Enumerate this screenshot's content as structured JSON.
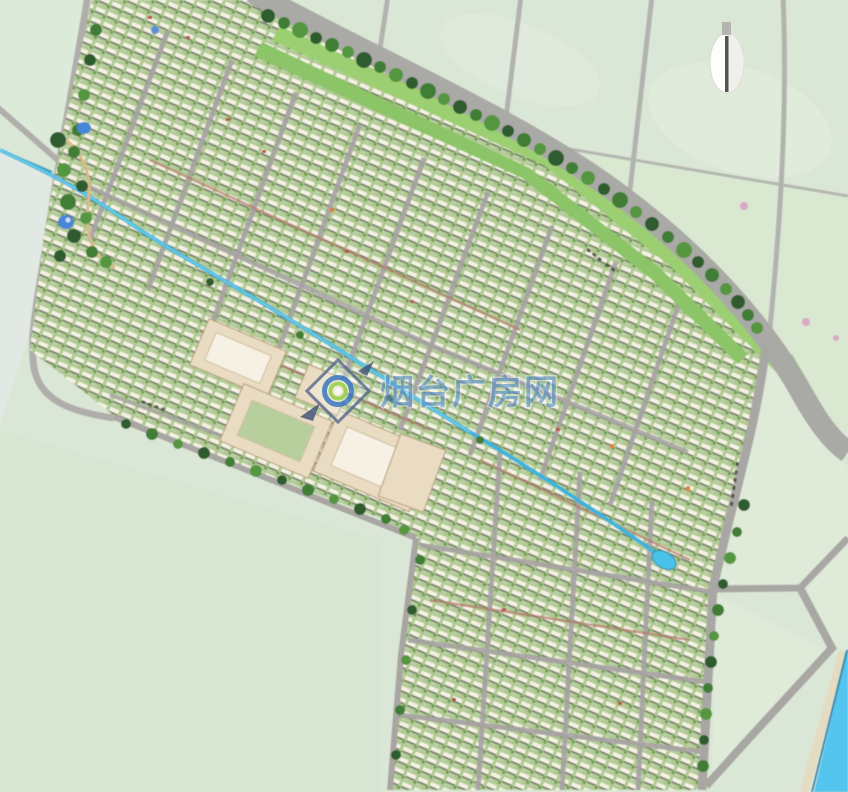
{
  "watermark": {
    "text": "烟台广房网",
    "logo": "diamond-lens-logo"
  },
  "compass": {
    "type": "north-arrow"
  },
  "map": {
    "kind": "residential-master-plan-rendering",
    "road_name_labels_legible": false
  },
  "colors": {
    "field": "#dbe7d6",
    "field_light": "#e6eee1",
    "field_wedge": "#d9e7d0",
    "lawn": "#b0c992",
    "building": "#f5f2e4",
    "road": "#a9a9a6",
    "road_minor": "#b2b2af",
    "verge": "#9ccf72",
    "tree_dark": "#2d5c2e",
    "tree_mid": "#3f7d36",
    "tree_light": "#55963f",
    "canal": "#3db4da",
    "river": "#52c5ee",
    "river_edge": "#2c8ab0",
    "shore": "#e4dcc2",
    "pond": "#4a86d8",
    "commercial_beige": "#e9dcc3",
    "watermark_blue": "#2e72be",
    "accent_red": "#bf4f46",
    "accent_orange": "#e08030"
  }
}
